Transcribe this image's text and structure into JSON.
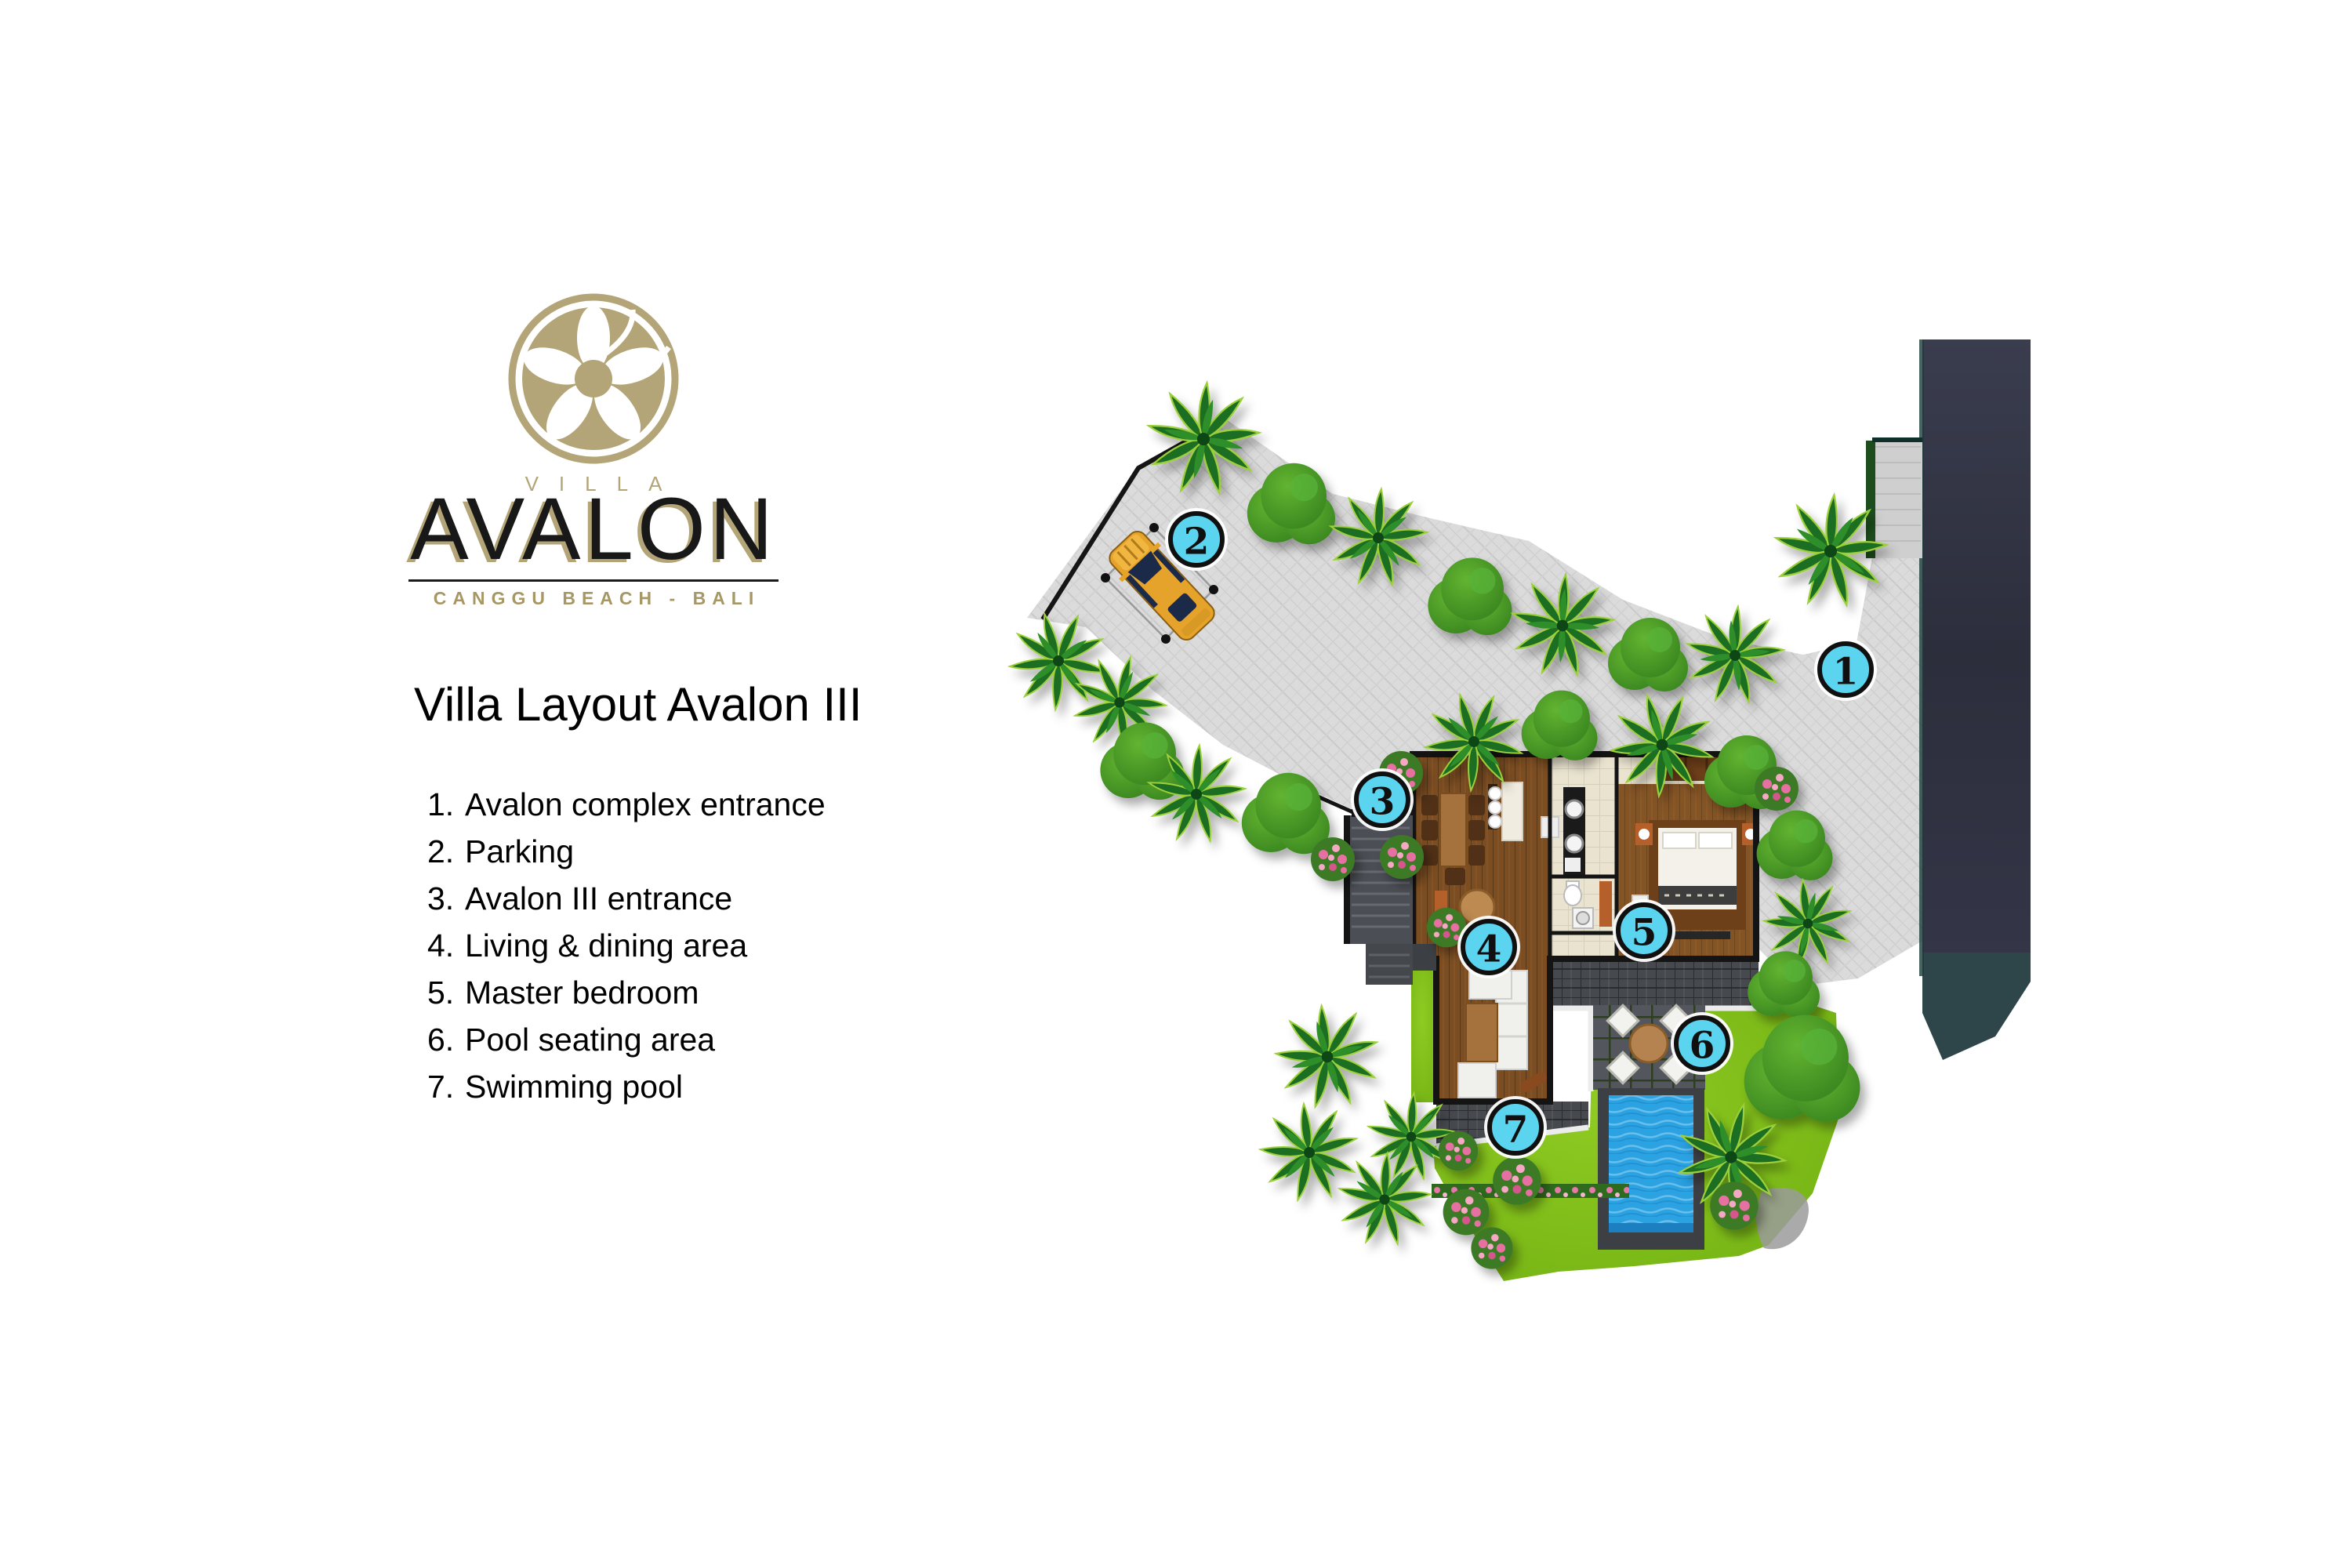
{
  "brand": {
    "villa_word": "VILLA",
    "name": "AVALON",
    "tagline": "CANGGU BEACH - BALI",
    "gold_color": "#b3a577"
  },
  "page": {
    "heading": "Villa Layout Avalon III"
  },
  "legend": {
    "items": [
      {
        "num": "1.",
        "label": "Avalon complex entrance"
      },
      {
        "num": "2.",
        "label": "Parking"
      },
      {
        "num": "3.",
        "label": "Avalon III entrance"
      },
      {
        "num": "4.",
        "label": "Living & dining area"
      },
      {
        "num": "5.",
        "label": "Master bedroom"
      },
      {
        "num": "6.",
        "label": "Pool seating area"
      },
      {
        "num": "7.",
        "label": "Swimming pool"
      }
    ]
  },
  "map": {
    "markers": [
      {
        "num": "1"
      },
      {
        "num": "2"
      },
      {
        "num": "3"
      },
      {
        "num": "4"
      },
      {
        "num": "5"
      },
      {
        "num": "6"
      },
      {
        "num": "7"
      }
    ],
    "colors": {
      "marker_fill": "#5bd4f0",
      "pavement": "#dbdbdb",
      "road": "#32344100",
      "road_dark": "#313341",
      "lawn": "#7dbf1a",
      "pool": "#2ba2e2",
      "wood_floor": "#7c4d21",
      "terrace": "#4a4d52"
    }
  }
}
